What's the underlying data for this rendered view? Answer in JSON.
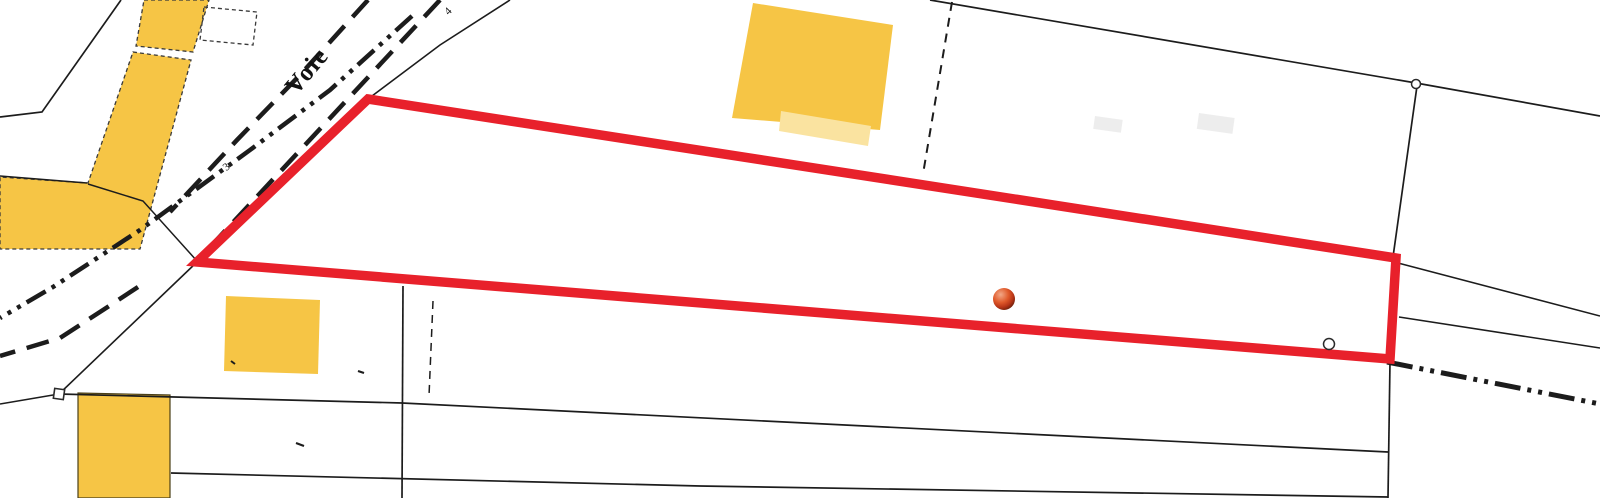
{
  "app": {
    "type": "cadastral-map-view"
  },
  "map": {
    "width": 1600,
    "height": 498,
    "background": "#ffffff",
    "palette": {
      "building_fill": "#F6C545",
      "building_fill_light": "#FAE3A0",
      "building_stroke": "#3a3a3a",
      "line_color": "#1c1c1c",
      "parcel_stroke": "#E8212B",
      "marker_stroke": "#2a2a2a",
      "marker_fill": "#ffffff"
    },
    "labels": [
      {
        "id": "road-name-label",
        "text": "Voie",
        "x": 313,
        "y": 76,
        "rotate": -50,
        "size": 25,
        "bold": true
      },
      {
        "id": "tick-label-4",
        "text": "4",
        "x": 451,
        "y": 13,
        "rotate": -45,
        "size": 11,
        "bold": false
      },
      {
        "id": "tick-label-3",
        "text": "3",
        "x": 229,
        "y": 169,
        "rotate": -40,
        "size": 11,
        "bold": false
      }
    ],
    "buildings": [
      {
        "id": "building-north-strip-upper",
        "points": [
          [
            144,
            0
          ],
          [
            209,
            0
          ],
          [
            193,
            52
          ],
          [
            136,
            46
          ]
        ],
        "fill": "#F6C545",
        "stroke": "dashed"
      },
      {
        "id": "building-west-l-shape",
        "points": [
          [
            133,
            52
          ],
          [
            191,
            60
          ],
          [
            140,
            249
          ],
          [
            0,
            249
          ],
          [
            0,
            177
          ],
          [
            88,
            183
          ]
        ],
        "fill": "#F6C545",
        "stroke": "dashed"
      },
      {
        "id": "building-north-center",
        "points": [
          [
            753,
            3
          ],
          [
            893,
            25
          ],
          [
            880,
            130
          ],
          [
            732,
            118
          ]
        ],
        "fill": "#F6C545",
        "stroke": "none"
      },
      {
        "id": "building-north-center-annex",
        "points": [
          [
            781,
            111
          ],
          [
            871,
            126
          ],
          [
            868,
            146
          ],
          [
            779,
            131
          ]
        ],
        "fill": "#FAE3A0",
        "stroke": "none"
      },
      {
        "id": "building-mid-small",
        "points": [
          [
            226,
            296
          ],
          [
            320,
            300
          ],
          [
            318,
            374
          ],
          [
            224,
            371
          ]
        ],
        "fill": "#F6C545",
        "stroke": "none"
      },
      {
        "id": "building-south-west",
        "points": [
          [
            78,
            393
          ],
          [
            170,
            395
          ],
          [
            170,
            498
          ],
          [
            78,
            498
          ]
        ],
        "fill": "#F6C545",
        "stroke": "solid"
      },
      {
        "id": "outbuilding-dashed-outline",
        "points": [
          [
            204,
            7
          ],
          [
            257,
            12
          ],
          [
            253,
            45
          ],
          [
            200,
            40
          ]
        ],
        "fill": "none",
        "stroke": "dashed"
      }
    ],
    "lines": [
      {
        "id": "boundary-northeast-of-parcel",
        "points": [
          [
            510,
            0
          ],
          [
            440,
            45
          ],
          [
            368,
            99
          ]
        ],
        "w": 1.6
      },
      {
        "id": "boundary-southwest-of-parcel",
        "points": [
          [
            197,
            262
          ],
          [
            59,
            394
          ]
        ],
        "w": 1.6
      },
      {
        "id": "boundary-west-tail",
        "points": [
          [
            59,
            394
          ],
          [
            0,
            404
          ]
        ],
        "w": 1.6
      },
      {
        "id": "parcel-south-boundary-long",
        "points": [
          [
            59,
            394
          ],
          [
            402,
            403
          ],
          [
            1388,
            452
          ]
        ],
        "w": 1.7
      },
      {
        "id": "parcel-south-boundary-second",
        "points": [
          [
            171,
            473
          ],
          [
            700,
            486
          ],
          [
            1388,
            497
          ]
        ],
        "w": 1.7
      },
      {
        "id": "boundary-vertical-mid",
        "points": [
          [
            403,
            286
          ],
          [
            402,
            498
          ]
        ],
        "w": 1.7
      },
      {
        "id": "boundary-vertical-mid-dashed",
        "points": [
          [
            433,
            301
          ],
          [
            429,
            396
          ]
        ],
        "w": 1.5,
        "dash": "8 6"
      },
      {
        "id": "boundary-vertical-east",
        "points": [
          [
            1390,
            362
          ],
          [
            1388,
            498
          ]
        ],
        "w": 1.7
      },
      {
        "id": "boundary-north-long",
        "points": [
          [
            930,
            0
          ],
          [
            1416,
            83
          ],
          [
            1600,
            116
          ]
        ],
        "w": 1.7
      },
      {
        "id": "boundary-east-vertical-upper",
        "points": [
          [
            1417,
            86
          ],
          [
            1393,
            257
          ]
        ],
        "w": 1.7
      },
      {
        "id": "boundary-branch-upper",
        "points": [
          [
            1398,
            263
          ],
          [
            1600,
            316
          ]
        ],
        "w": 1.5
      },
      {
        "id": "boundary-branch-lower",
        "points": [
          [
            1399,
            317
          ],
          [
            1600,
            348
          ]
        ],
        "w": 1.5
      },
      {
        "id": "boundary-dashed-north",
        "points": [
          [
            952,
            2
          ],
          [
            923,
            174
          ]
        ],
        "w": 2,
        "dash": "9 7"
      },
      {
        "id": "corner-northwest-boundary",
        "points": [
          [
            121,
            0
          ],
          [
            42,
            112
          ],
          [
            0,
            117
          ]
        ],
        "w": 1.7
      },
      {
        "id": "west-arm-top-edge",
        "points": [
          [
            0,
            176
          ],
          [
            87,
            183
          ]
        ],
        "w": 1.5
      },
      {
        "id": "boundary-to-parcel-vertex",
        "points": [
          [
            88,
            184
          ],
          [
            143,
            201
          ],
          [
            197,
            261
          ]
        ],
        "w": 1.5
      },
      {
        "id": "road-edge-southeast",
        "points": [
          [
            440,
            0
          ],
          [
            197,
            261
          ]
        ],
        "w": 4.5,
        "dash": "23 12"
      },
      {
        "id": "road-edge-northwest",
        "points": [
          [
            368,
            0
          ],
          [
            300,
            75
          ],
          [
            237,
            140
          ],
          [
            170,
            212
          ]
        ],
        "w": 4.5,
        "dash": "23 12"
      },
      {
        "id": "road-edge-southwest-lower",
        "points": [
          [
            138,
            287
          ],
          [
            103,
            310
          ],
          [
            60,
            338
          ],
          [
            0,
            356
          ]
        ],
        "w": 4.5,
        "dash": "23 12"
      },
      {
        "id": "road-axis-dashdot",
        "points": [
          [
            412,
            16
          ],
          [
            330,
            90
          ],
          [
            250,
            150
          ],
          [
            140,
            230
          ],
          [
            53,
            287
          ],
          [
            0,
            318
          ]
        ],
        "w": 4.5,
        "dash": "22 7 4 7 4 7"
      },
      {
        "id": "road-axis-dashdot-southeast",
        "points": [
          [
            1387,
            362
          ],
          [
            1600,
            404
          ]
        ],
        "w": 5,
        "dash": "26 7 4 7 4 7"
      }
    ],
    "tiny_marks": [
      {
        "id": "tiny-mark-a",
        "points": [
          [
            358,
            371
          ],
          [
            364,
            373
          ]
        ],
        "w": 2.2
      },
      {
        "id": "tiny-mark-b",
        "points": [
          [
            296,
            443
          ],
          [
            304,
            446
          ]
        ],
        "w": 2.2
      },
      {
        "id": "tiny-mark-c",
        "points": [
          [
            231,
            361
          ],
          [
            235,
            364
          ]
        ],
        "w": 2.0
      }
    ],
    "parcel_highlight": {
      "id": "parcel-highlight",
      "points": [
        [
          368,
          99
        ],
        [
          1396,
          258
        ],
        [
          1390,
          359
        ],
        [
          197,
          262
        ]
      ],
      "stroke": "#E8212B",
      "stroke_width": 9.5
    },
    "markers": [
      {
        "id": "corner-square-marker",
        "type": "square",
        "x": 59,
        "y": 394,
        "size": 10,
        "rotate": 8
      },
      {
        "id": "corner-circle-marker-north",
        "type": "circle",
        "x": 1416,
        "y": 84,
        "r": 4.5
      },
      {
        "id": "corner-circle-marker-south",
        "type": "circle",
        "x": 1329,
        "y": 344,
        "r": 5.5
      }
    ],
    "location_dot": {
      "id": "location-dot",
      "x": 1004,
      "y": 299,
      "r": 11,
      "gradient": [
        "#F2A887",
        "#E05A2B",
        "#B83517",
        "#591A08"
      ]
    },
    "smudges": [
      {
        "x": 1095,
        "y": 116,
        "w": 28,
        "h": 13,
        "rotate": 8
      },
      {
        "x": 1199,
        "y": 113,
        "w": 36,
        "h": 16,
        "rotate": 8
      }
    ]
  }
}
